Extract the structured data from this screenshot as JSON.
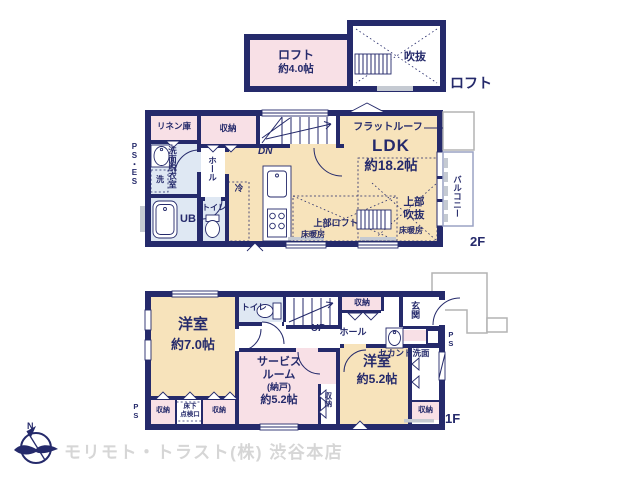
{
  "colors": {
    "navy": "#252a6b",
    "pink": "#f8e0e6",
    "beige": "#f7e3bb",
    "blue": "#dfe8f3",
    "gray_sill": "#c5cad2",
    "outline_gray": "#b3b3b3",
    "logo_gray": "#d6d6d6"
  },
  "loft": {
    "room": "ロフト",
    "room_size": "約4.0帖",
    "void_room": "吹抜",
    "floor_label": "ロフト"
  },
  "f2": {
    "linen": "リネン庫",
    "closet": "収納",
    "dn": "DN",
    "flat_roof": "フラットルーフ",
    "ldk": "LDK",
    "ldk_size": "約18.2帖",
    "ps_es": "PS・ES",
    "washroom": "洗面脱衣室",
    "washer": "洗",
    "hall": "ホール",
    "ub": "UB",
    "toilet": "トイレ",
    "fridge": "冷",
    "upper_loft": "上部ロフト",
    "floor_heating_left": "床暖房",
    "upper_void_1": "上部",
    "upper_void_2": "吹抜",
    "floor_heating_right": "床暖房",
    "balcony": "バルコニー",
    "floor_label": "2F"
  },
  "f1": {
    "room7": "洋室",
    "room7_size": "約7.0帖",
    "toilet": "トイレ",
    "up": "UP",
    "closet_top": "収納",
    "hall": "ホール",
    "entrance": "玄関",
    "second_basin": "セカンド洗面",
    "service_l1": "サービス",
    "service_l2": "ルーム",
    "service_l3": "(納戸)",
    "service_l4": "約5.2帖",
    "closet_mid": "収納",
    "room5": "洋室",
    "room5_size": "約5.2帖",
    "closet_right": "収納",
    "closet_bl1": "収納",
    "underfloor_l1": "床下",
    "underfloor_l2": "点検口",
    "closet_bl2": "収納",
    "ps_left": "PS",
    "ps_right": "PS",
    "floor_label": "1F"
  },
  "footer": {
    "compass_n": "N",
    "company": "モリモト・トラスト(株) 渋谷本店"
  }
}
